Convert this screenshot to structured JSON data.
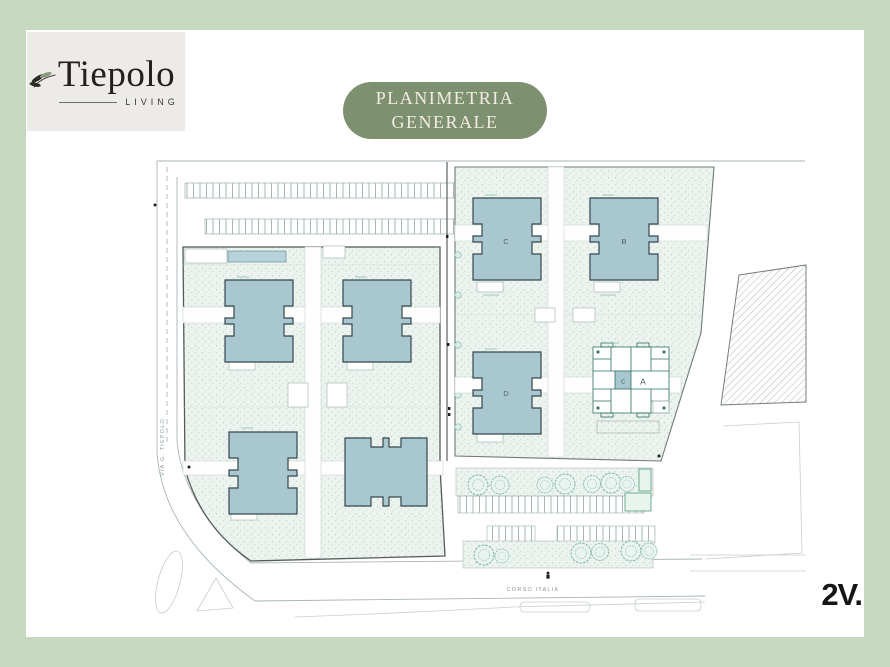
{
  "logo": {
    "brand": "Tiepolo",
    "tagline": "LIVING"
  },
  "badge": {
    "line1": "PLANIMETRIA",
    "line2": "GENERALE"
  },
  "plan": {
    "streets": {
      "left": "VIA G. TIEPOLO",
      "bottom": "CORSO ITALIA"
    },
    "building_labels": {
      "a": "A",
      "b": "B",
      "c": "C",
      "d": "D",
      "core": "C"
    }
  },
  "footer": {
    "brand": "2V."
  },
  "icons": {
    "logo": "olive-branch-icon",
    "street_symbol": "pedestrian-icon"
  },
  "colors": {
    "frame": "#c7d8c0",
    "panel": "#ffffff",
    "logo_card": "#edebe7",
    "badge_bg": "#7d9070",
    "badge_text": "#f2ede1",
    "building_fill": "#a9c7d1",
    "tree": "#74b2a8",
    "ink": "#1d1d1b"
  }
}
